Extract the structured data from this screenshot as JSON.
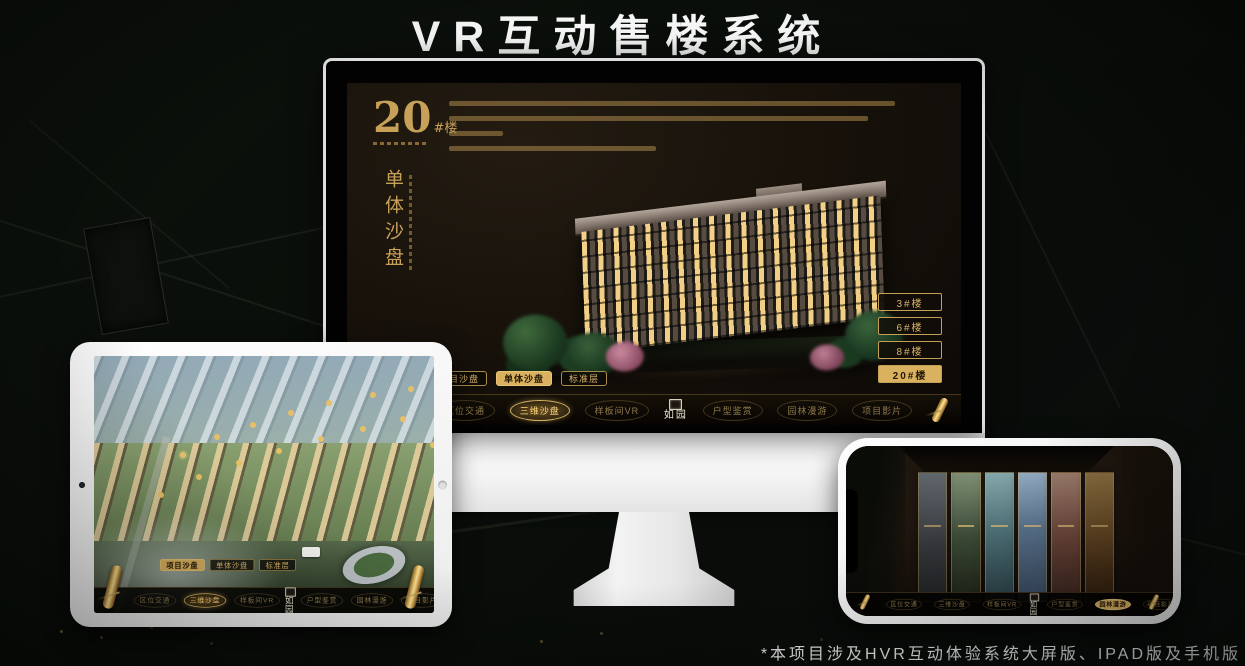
{
  "page": {
    "title": "VR互动售楼系统",
    "footnote": "*本项目涉及HVR互动体验系统大屏版、IPAD版及手机版"
  },
  "colors": {
    "gold": "#c9a35c",
    "gold_bright": "#d9b15f",
    "screen_bg": "#17110b",
    "background": "#0a0e0a"
  },
  "monitor": {
    "heading": {
      "number": "20",
      "suffix": "#楼",
      "vertical_title": "单体沙盘"
    },
    "floor_buttons": [
      {
        "label": "3#楼",
        "active": false
      },
      {
        "label": "6#楼",
        "active": false
      },
      {
        "label": "8#楼",
        "active": false
      },
      {
        "label": "20#楼",
        "active": true
      }
    ],
    "sub_tabs": [
      {
        "label": "项目沙盘",
        "active": false
      },
      {
        "label": "单体沙盘",
        "active": true
      },
      {
        "label": "标准层",
        "active": false
      }
    ],
    "nav": {
      "logo": "如园",
      "items": [
        {
          "label": "区位交通",
          "active": false
        },
        {
          "label": "三维沙盘",
          "active": true
        },
        {
          "label": "样板间VR",
          "active": false
        },
        {
          "label": "户型鉴赏",
          "active": false
        },
        {
          "label": "园林漫游",
          "active": false
        },
        {
          "label": "项目影片",
          "active": false
        }
      ]
    }
  },
  "tablet": {
    "sub_tabs": [
      {
        "label": "项目沙盘",
        "active": true
      },
      {
        "label": "单体沙盘",
        "active": false
      },
      {
        "label": "标准层",
        "active": false
      }
    ],
    "nav": {
      "logo": "如园",
      "items": [
        {
          "label": "区位交通",
          "active": false
        },
        {
          "label": "三维沙盘",
          "active": true
        },
        {
          "label": "样板间VR",
          "active": false
        },
        {
          "label": "户型鉴赏",
          "active": false
        },
        {
          "label": "园林漫游",
          "active": false
        },
        {
          "label": "项目影片",
          "active": false
        }
      ]
    }
  },
  "phone": {
    "nav": {
      "logo": "如园",
      "items": [
        {
          "label": "区位交通",
          "active": false
        },
        {
          "label": "三维沙盘",
          "active": false
        },
        {
          "label": "样板间VR",
          "active": false
        },
        {
          "label": "户型鉴赏",
          "active": false
        },
        {
          "label": "园林漫游",
          "active": true
        },
        {
          "label": "项目影片",
          "active": false
        }
      ]
    }
  }
}
